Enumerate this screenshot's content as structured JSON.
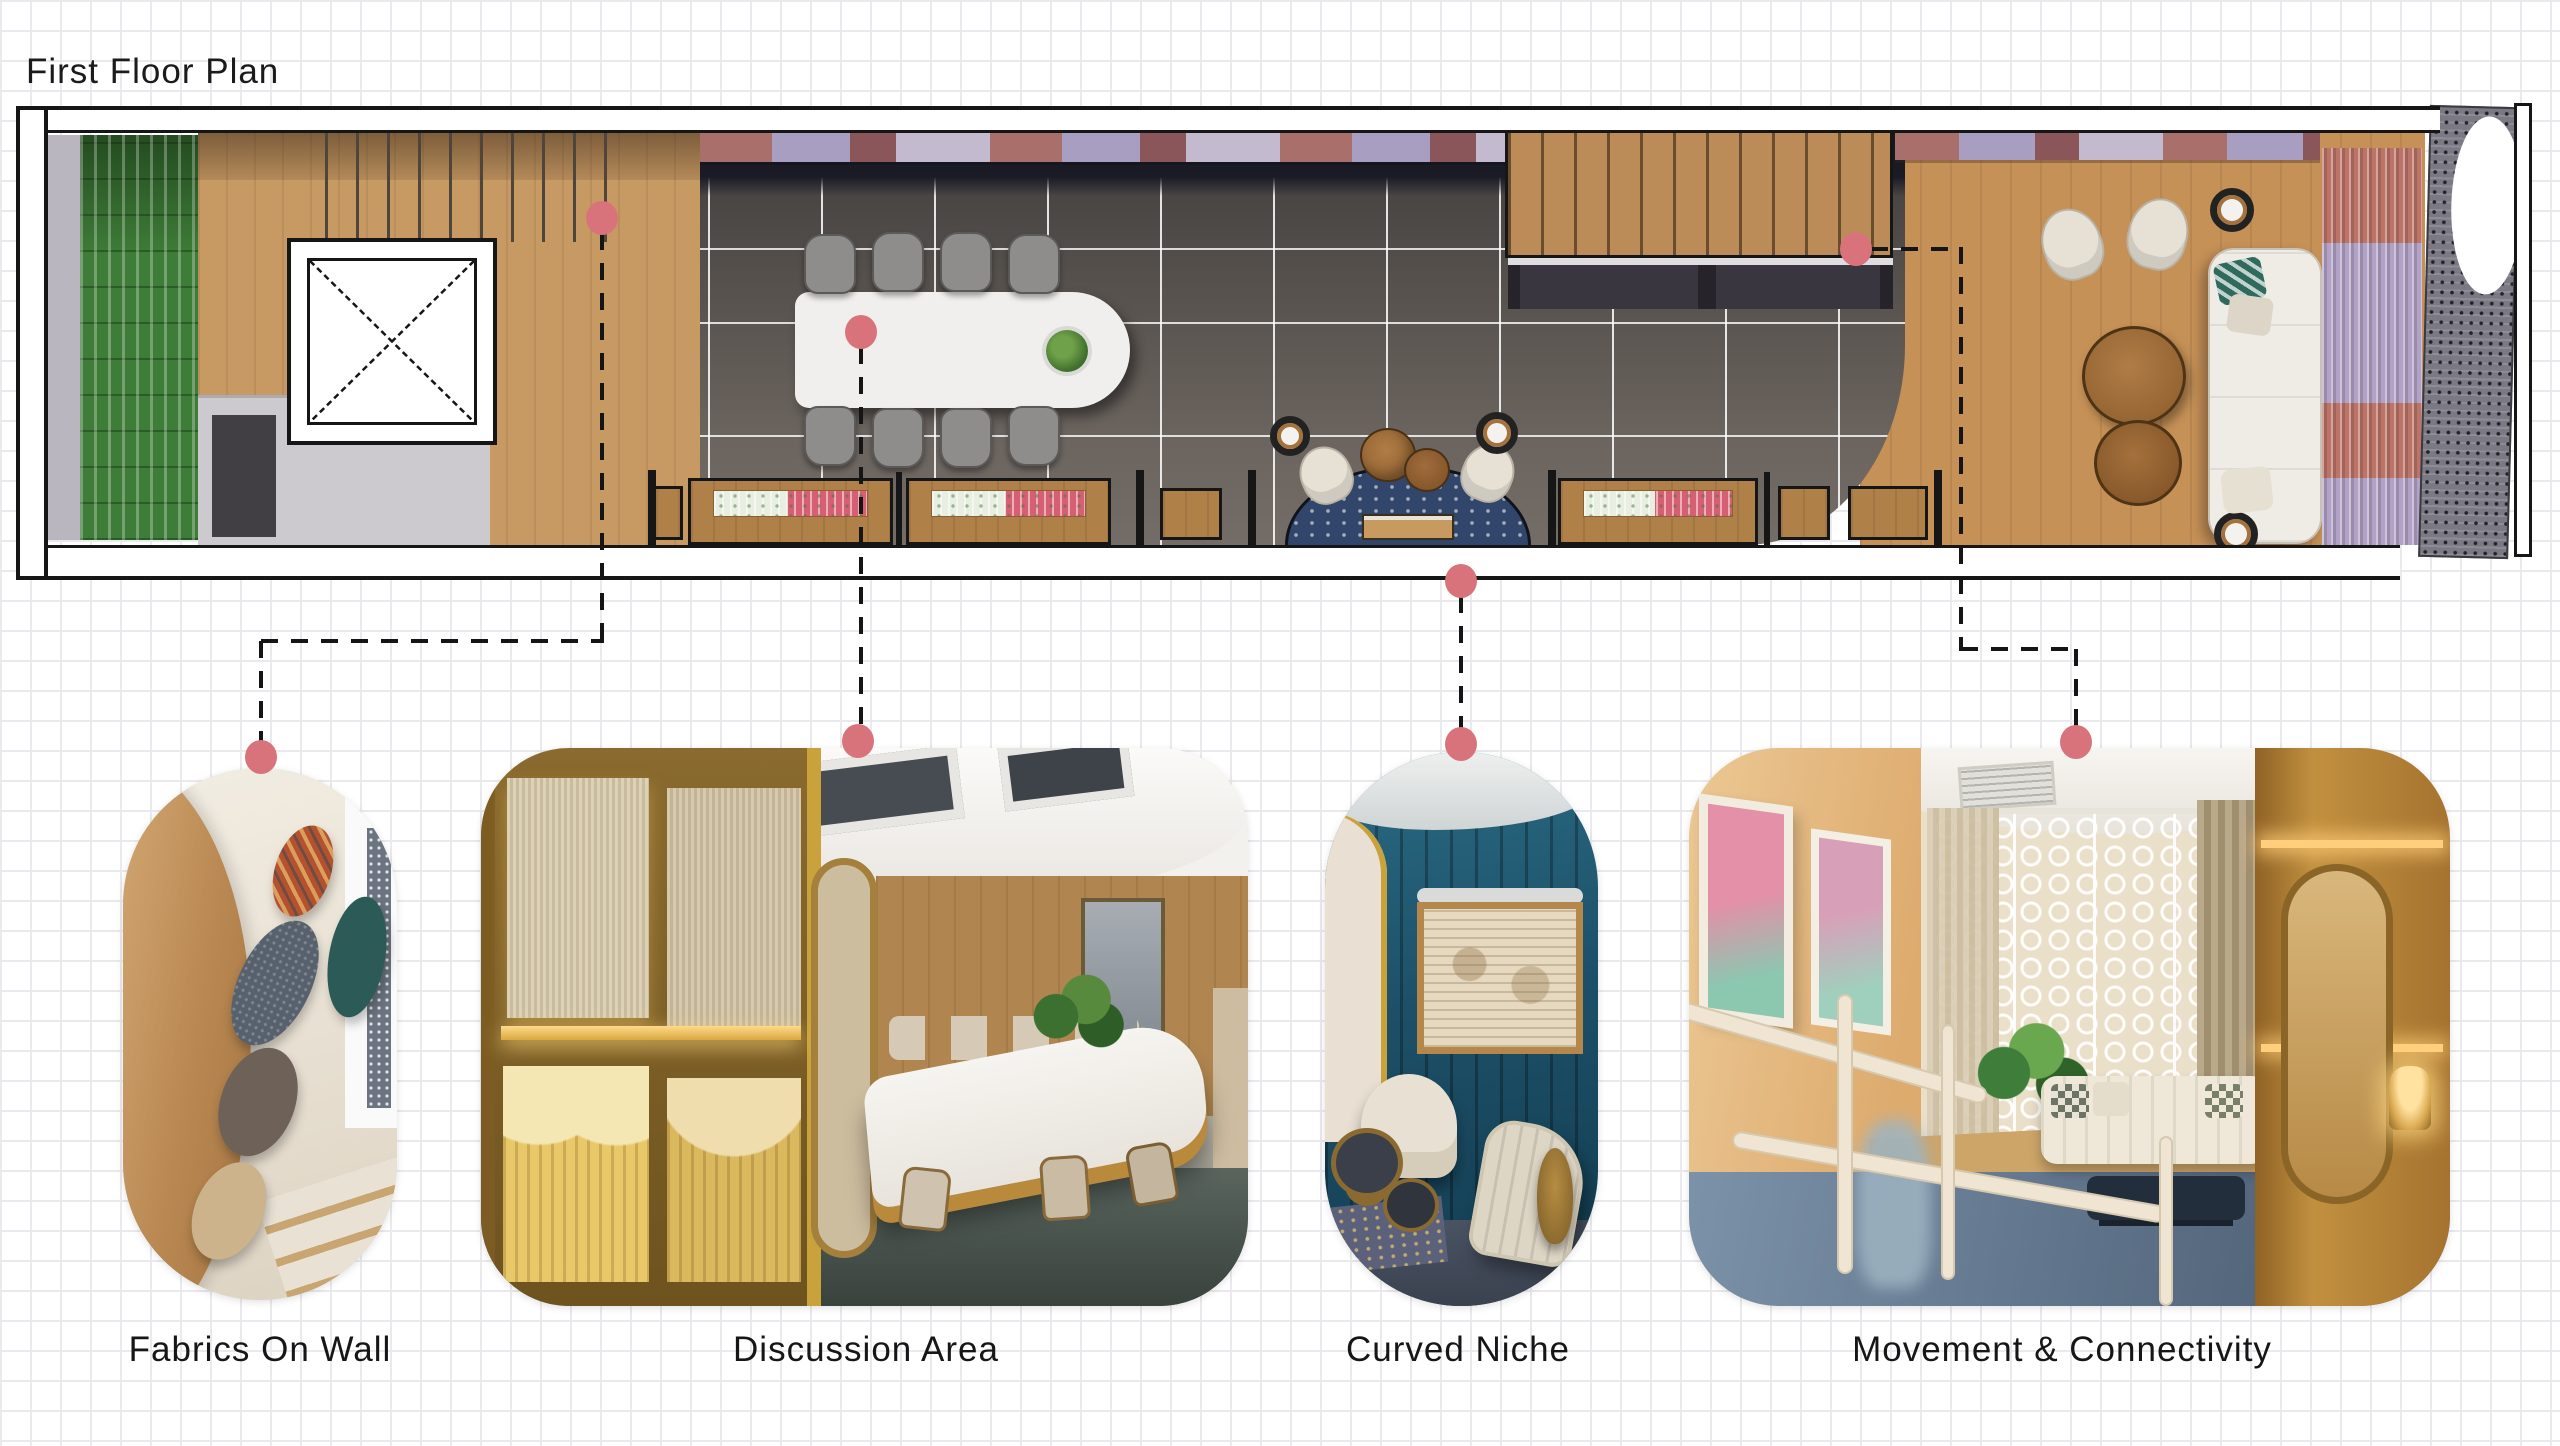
{
  "title": "First Floor Plan",
  "plan": {
    "name": "first-floor-plan",
    "markers": [
      {
        "id": "marker-fabrics-on-wall",
        "links_to": "fabrics-on-wall"
      },
      {
        "id": "marker-discussion-area",
        "links_to": "discussion-area"
      },
      {
        "id": "marker-curved-niche",
        "links_to": "curved-niche"
      },
      {
        "id": "marker-movement-connectivity",
        "links_to": "movement-connectivity"
      }
    ]
  },
  "callouts": [
    {
      "id": "fabrics-on-wall",
      "label": "Fabrics On Wall"
    },
    {
      "id": "discussion-area",
      "label": "Discussion Area"
    },
    {
      "id": "curved-niche",
      "label": "Curved Niche"
    },
    {
      "id": "movement-connectivity",
      "label": "Movement & Connectivity"
    }
  ],
  "colors": {
    "accent_marker": "#d9737b",
    "leader_line": "#151515",
    "grid_line": "#eaeaee",
    "paper": "#ffffff"
  }
}
